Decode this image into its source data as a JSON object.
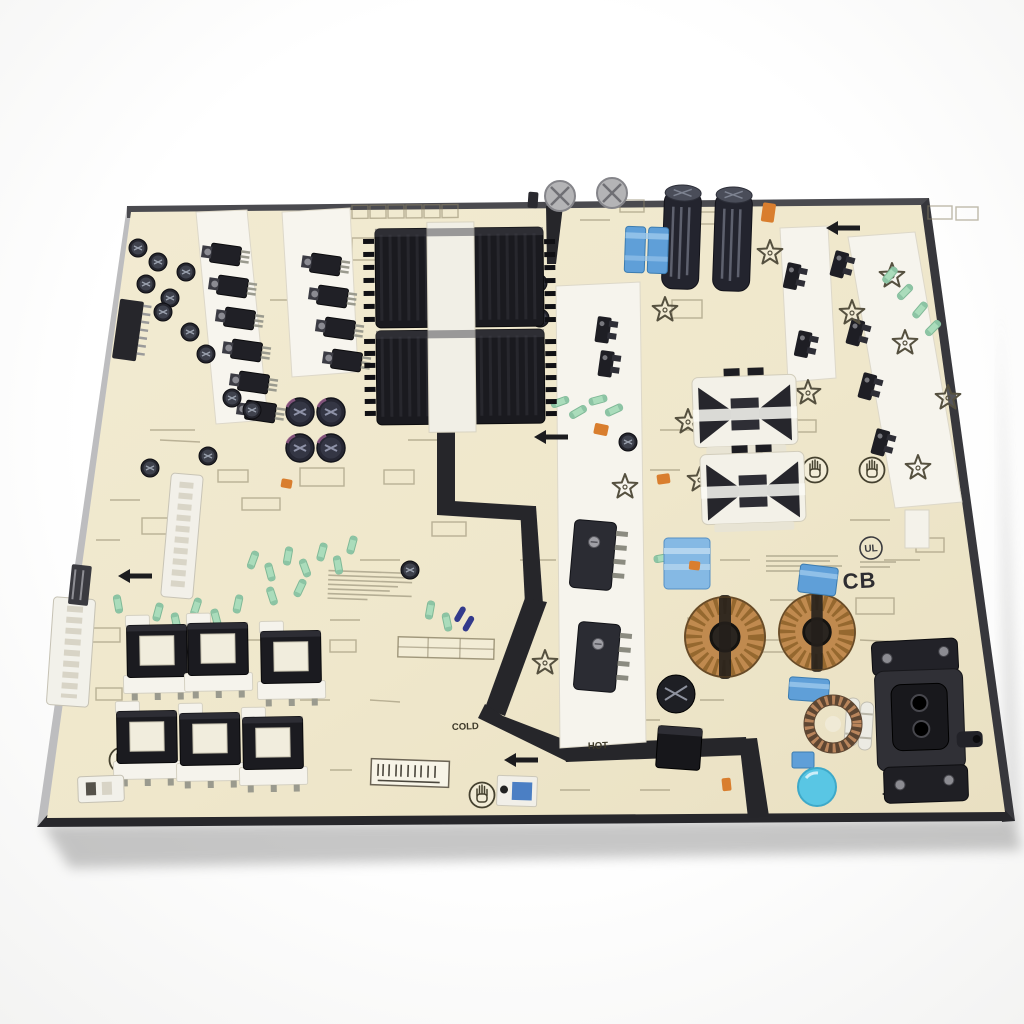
{
  "scene": {
    "type": "product-photo",
    "subject": "Television switching power supply unit (PSU) printed circuit board lying on a white studio background, photographed at a slight tilt",
    "background_color": "#fdfdfd",
    "board_substrate_color": "#efe7cb",
    "regions": {
      "primary_side_label": "HOT",
      "secondary_side_label": "COLD"
    }
  },
  "labels": {
    "cb": "CB",
    "hot": "HOT",
    "cold": "COLD",
    "ul_mark": "UL"
  },
  "colors": {
    "background": "#fdfdfd",
    "shadow": "rgba(0,0,0,0.16)",
    "pcb": "#efe7cb",
    "pcb_edge_dark": "#3a3a3e",
    "pcb_edge_light": "#bdbdbf",
    "silkscreen": "#8d8468",
    "isolation_barrier": "#26262a",
    "component_black": "#1d1d22",
    "heatsink_white": "#f6f4ed",
    "film_cap_blue": "#5f9fd8",
    "film_cap_light_blue": "#85b9e4",
    "electrolytic_navy": "#23242e",
    "toroid_copper": "#c08a4f",
    "disc_cap_cyan": "#59c6e4",
    "resistor_mint": "#aadcbb",
    "thermistor_orange": "#d97e2e"
  },
  "component_inventory": {
    "output_transformers_bottom_left": 6,
    "main_transformers_center": 2,
    "toroidal_chokes_copper": 2,
    "primary_bulk_capacitors": 2,
    "finned_heatsink_transformer_blocks": 2,
    "white_heatsink_strips": 4,
    "to220_transistors": 10,
    "blue_film_capacitors": 6,
    "ac_power_inlet": 1,
    "edge_connectors_left": 4,
    "esd_hand_symbols": 4,
    "star_silkscreen_marks": 12,
    "direction_arrows": 7
  }
}
